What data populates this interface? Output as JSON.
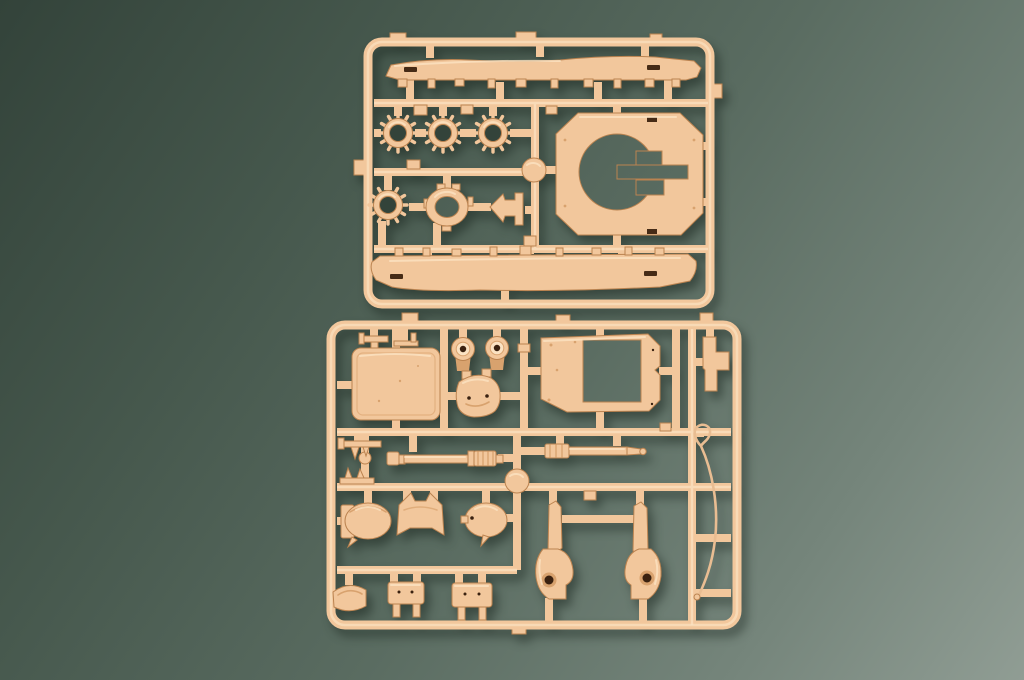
{
  "colors": {
    "bg1": "#33433a",
    "bg2": "#46584d",
    "bg3": "#5a6c61",
    "bg4": "#75857b",
    "bg5": "#909d94",
    "plastic": "#f2c79c",
    "plasticHi": "#fbe2c2",
    "plasticDk": "#d8a26e",
    "plasticEdge": "#bb8350",
    "deep": "#3a2110",
    "slot": "#462b16",
    "cable": "#e9bd92"
  },
  "scene": {
    "subject": "two tan plastic model-kit sprues photographed on a dark green surface",
    "sprue_top_parts": [
      "upper-hull-side",
      "lower-hull-side",
      "drive-sprocket-1",
      "drive-sprocket-2",
      "drive-sprocket-3",
      "drive-sprocket-4",
      "hatch-ring",
      "clamp-bracket",
      "turret-ring-plate"
    ],
    "sprue_bottom_parts": [
      "roof-panel",
      "roller-1",
      "roller-2",
      "gun-mantlet",
      "casemate-frame",
      "stepped-block",
      "gun-barrel-1",
      "gun-barrel-2",
      "cupola-dome-1",
      "saddle-mount",
      "cupola-dome-2",
      "trunnion-mount-left",
      "trunnion-mount-right",
      "tow-cable",
      "curved-clamp",
      "bracket-1",
      "bracket-2"
    ]
  }
}
